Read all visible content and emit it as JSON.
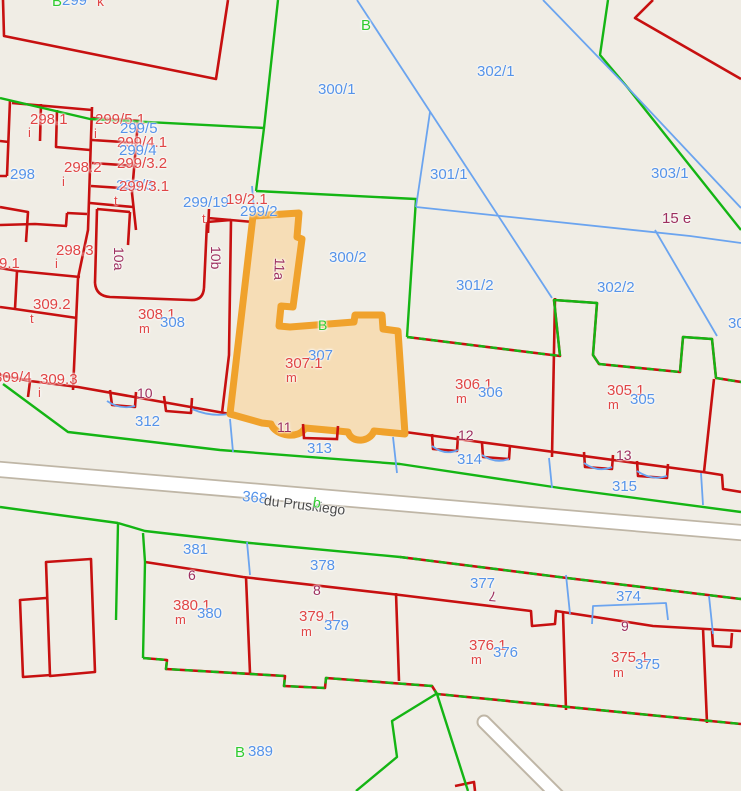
{
  "meta": {
    "map_type": "cadastral parcel map",
    "highlighted_parcel": "307.1",
    "street_number": "368",
    "street_name": "du Pruskiego"
  },
  "colors": {
    "background": "#f0ede5",
    "parcel_line_red": "#c71010",
    "boundary_green": "#14b514",
    "boundary_blue": "#6ba4ef",
    "highlight_stroke": "#f0a22c",
    "highlight_fill": "#f6ddb6",
    "road_fill": "#ffffff",
    "road_casing": "#bfb6a6",
    "label_blue": "#5593e9",
    "label_red": "#e04545",
    "label_maroon": "#9d2f5f",
    "label_green": "#2fcb2f",
    "label_gray": "#4c4c4c"
  },
  "labels": [
    {
      "t": "B",
      "x": 52,
      "y": -6,
      "c": "green"
    },
    {
      "t": "299",
      "x": 62,
      "y": -7,
      "c": "blue"
    },
    {
      "t": "k",
      "x": 97,
      "y": -6,
      "c": "red",
      "s": 14
    },
    {
      "t": "298.1",
      "x": 30,
      "y": 112,
      "c": "red"
    },
    {
      "t": "i",
      "x": 28,
      "y": 126,
      "c": "red",
      "s": 13
    },
    {
      "t": "298",
      "x": 10,
      "y": 167,
      "c": "blue"
    },
    {
      "t": "298.2",
      "x": 64,
      "y": 160,
      "c": "red"
    },
    {
      "t": "i",
      "x": 62,
      "y": 175,
      "c": "red",
      "s": 13
    },
    {
      "t": "299/5.1",
      "x": 95,
      "y": 112,
      "c": "red"
    },
    {
      "t": "299/5",
      "x": 120,
      "y": 121,
      "c": "blue"
    },
    {
      "t": "i",
      "x": 94,
      "y": 127,
      "c": "red",
      "s": 13
    },
    {
      "t": "299/4.1",
      "x": 117,
      "y": 135,
      "c": "red"
    },
    {
      "t": "299/4",
      "x": 119,
      "y": 143,
      "c": "blue"
    },
    {
      "t": "299/3.2",
      "x": 117,
      "y": 156,
      "c": "red"
    },
    {
      "t": "299/3",
      "x": 116,
      "y": 178,
      "c": "blue"
    },
    {
      "t": "299/3.1",
      "x": 119,
      "y": 179,
      "c": "red"
    },
    {
      "t": "t",
      "x": 114,
      "y": 194,
      "c": "red",
      "s": 13
    },
    {
      "t": "298.3",
      "x": 56,
      "y": 243,
      "c": "red"
    },
    {
      "t": "i",
      "x": 55,
      "y": 257,
      "c": "red",
      "s": 13
    },
    {
      "t": "9.1",
      "x": -1,
      "y": 256,
      "c": "red"
    },
    {
      "t": "309.2",
      "x": 33,
      "y": 297,
      "c": "red"
    },
    {
      "t": "t",
      "x": 30,
      "y": 312,
      "c": "red",
      "s": 13
    },
    {
      "t": "309/4",
      "x": -6,
      "y": 370,
      "c": "red"
    },
    {
      "t": "309.3",
      "x": 40,
      "y": 372,
      "c": "red"
    },
    {
      "t": "i",
      "x": 38,
      "y": 386,
      "c": "red",
      "s": 13
    },
    {
      "t": "299/19",
      "x": 183,
      "y": 195,
      "c": "blue"
    },
    {
      "t": "19/2.1",
      "x": 226,
      "y": 192,
      "c": "red"
    },
    {
      "t": "299/2",
      "x": 240,
      "y": 204,
      "c": "blue"
    },
    {
      "t": "t",
      "x": 202,
      "y": 212,
      "c": "red",
      "s": 13
    },
    {
      "t": "300/1",
      "x": 318,
      "y": 82,
      "c": "blue"
    },
    {
      "t": "B",
      "x": 361,
      "y": 18,
      "c": "green"
    },
    {
      "t": "302/1",
      "x": 477,
      "y": 64,
      "c": "blue"
    },
    {
      "t": "301/1",
      "x": 430,
      "y": 167,
      "c": "blue"
    },
    {
      "t": "303/1",
      "x": 651,
      "y": 166,
      "c": "blue"
    },
    {
      "t": "15 e",
      "x": 662,
      "y": 211,
      "c": "maroon"
    },
    {
      "t": "30",
      "x": 728,
      "y": 316,
      "c": "blue"
    },
    {
      "t": "300/2",
      "x": 329,
      "y": 250,
      "c": "blue"
    },
    {
      "t": "301/2",
      "x": 456,
      "y": 278,
      "c": "blue"
    },
    {
      "t": "302/2",
      "x": 597,
      "y": 280,
      "c": "blue"
    },
    {
      "t": "10a",
      "x": 126,
      "y": 247,
      "c": "maroon",
      "s": 14,
      "r": 90
    },
    {
      "t": "10b",
      "x": 223,
      "y": 246,
      "c": "maroon",
      "s": 14,
      "r": 90
    },
    {
      "t": "11a",
      "x": 287,
      "y": 258,
      "c": "maroon",
      "s": 14,
      "r": 92
    },
    {
      "t": "308.1",
      "x": 138,
      "y": 307,
      "c": "red"
    },
    {
      "t": "m",
      "x": 139,
      "y": 322,
      "c": "red",
      "s": 13
    },
    {
      "t": "308",
      "x": 160,
      "y": 315,
      "c": "blue"
    },
    {
      "t": "B",
      "x": 318,
      "y": 318,
      "c": "green",
      "s": 14
    },
    {
      "t": "307",
      "x": 308,
      "y": 348,
      "c": "blue"
    },
    {
      "t": "307.1",
      "x": 285,
      "y": 356,
      "c": "red"
    },
    {
      "t": "m",
      "x": 286,
      "y": 371,
      "c": "red",
      "s": 13
    },
    {
      "t": "306.1",
      "x": 455,
      "y": 377,
      "c": "red"
    },
    {
      "t": "m",
      "x": 456,
      "y": 392,
      "c": "red",
      "s": 13
    },
    {
      "t": "306",
      "x": 478,
      "y": 385,
      "c": "blue"
    },
    {
      "t": "305.1",
      "x": 607,
      "y": 383,
      "c": "red"
    },
    {
      "t": "m",
      "x": 608,
      "y": 398,
      "c": "red",
      "s": 13
    },
    {
      "t": "305",
      "x": 630,
      "y": 392,
      "c": "blue"
    },
    {
      "t": "10",
      "x": 137,
      "y": 386,
      "c": "maroon",
      "s": 14
    },
    {
      "t": "312",
      "x": 135,
      "y": 414,
      "c": "blue"
    },
    {
      "t": "11",
      "x": 277,
      "y": 420,
      "c": "maroon",
      "s": 14
    },
    {
      "t": "313",
      "x": 307,
      "y": 441,
      "c": "blue"
    },
    {
      "t": "12",
      "x": 458,
      "y": 428,
      "c": "maroon",
      "s": 14
    },
    {
      "t": "314",
      "x": 457,
      "y": 452,
      "c": "blue"
    },
    {
      "t": "13",
      "x": 616,
      "y": 448,
      "c": "maroon",
      "s": 14
    },
    {
      "t": "315",
      "x": 612,
      "y": 479,
      "c": "blue"
    },
    {
      "t": "368",
      "x": 243,
      "y": 489,
      "c": "blue",
      "r": 6
    },
    {
      "t": "du Pruskiego",
      "x": 265,
      "y": 493,
      "c": "gray",
      "s": 14,
      "r": 7
    },
    {
      "t": "b",
      "x": 314,
      "y": 495,
      "c": "green",
      "s": 14,
      "r": 7
    },
    {
      "t": "381",
      "x": 183,
      "y": 542,
      "c": "blue"
    },
    {
      "t": "6",
      "x": 188,
      "y": 568,
      "c": "maroon",
      "s": 14
    },
    {
      "t": "378",
      "x": 310,
      "y": 558,
      "c": "blue"
    },
    {
      "t": "8",
      "x": 313,
      "y": 583,
      "c": "maroon",
      "s": 14
    },
    {
      "t": "380.1",
      "x": 173,
      "y": 598,
      "c": "red"
    },
    {
      "t": "m",
      "x": 175,
      "y": 613,
      "c": "red",
      "s": 13
    },
    {
      "t": "380",
      "x": 197,
      "y": 606,
      "c": "blue"
    },
    {
      "t": "379.1",
      "x": 299,
      "y": 609,
      "c": "red"
    },
    {
      "t": "m",
      "x": 301,
      "y": 625,
      "c": "red",
      "s": 13
    },
    {
      "t": "379",
      "x": 324,
      "y": 618,
      "c": "blue"
    },
    {
      "t": "377",
      "x": 470,
      "y": 576,
      "c": "blue"
    },
    {
      "t": "7",
      "x": 496,
      "y": 604,
      "c": "maroon",
      "s": 14,
      "r": 185
    },
    {
      "t": "374",
      "x": 616,
      "y": 589,
      "c": "blue"
    },
    {
      "t": "9",
      "x": 621,
      "y": 619,
      "c": "maroon",
      "s": 14
    },
    {
      "t": "376.1",
      "x": 469,
      "y": 638,
      "c": "red"
    },
    {
      "t": "m",
      "x": 471,
      "y": 653,
      "c": "red",
      "s": 13
    },
    {
      "t": "376",
      "x": 493,
      "y": 645,
      "c": "blue"
    },
    {
      "t": "375.1",
      "x": 611,
      "y": 650,
      "c": "red"
    },
    {
      "t": "m",
      "x": 613,
      "y": 666,
      "c": "red",
      "s": 13
    },
    {
      "t": "375",
      "x": 635,
      "y": 657,
      "c": "blue"
    },
    {
      "t": "B",
      "x": 235,
      "y": 745,
      "c": "green"
    },
    {
      "t": "389",
      "x": 248,
      "y": 744,
      "c": "blue"
    }
  ]
}
